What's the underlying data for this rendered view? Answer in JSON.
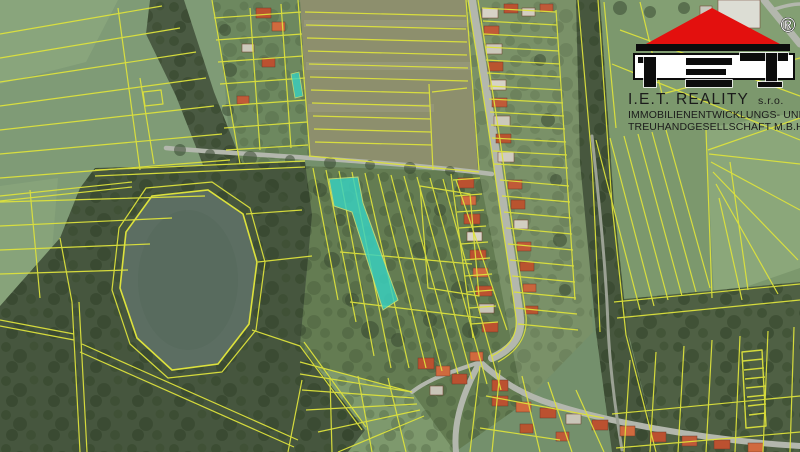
{
  "map": {
    "kind": "aerial-cadastral-map",
    "colors": {
      "base": "#74906c",
      "parcel_line": "#dde23c",
      "highlight": "#38d2c2",
      "field_olive": "#8d8f6d",
      "forest": "#46563e",
      "water": "#5c6e62",
      "road": "#b3b7ad"
    }
  },
  "logo": {
    "monogram": "IET",
    "registered_mark": "®",
    "company": "I.E.T. REALITY",
    "legal_form": "s.r.o.",
    "description_line1": "IMMOBILIENENTWICKLUNGS- UND",
    "description_line2": "TREUHANDGESELLSCHAFT M.B.H.",
    "roof_color": "#e3100e",
    "text_color": "#1b1b1b"
  }
}
